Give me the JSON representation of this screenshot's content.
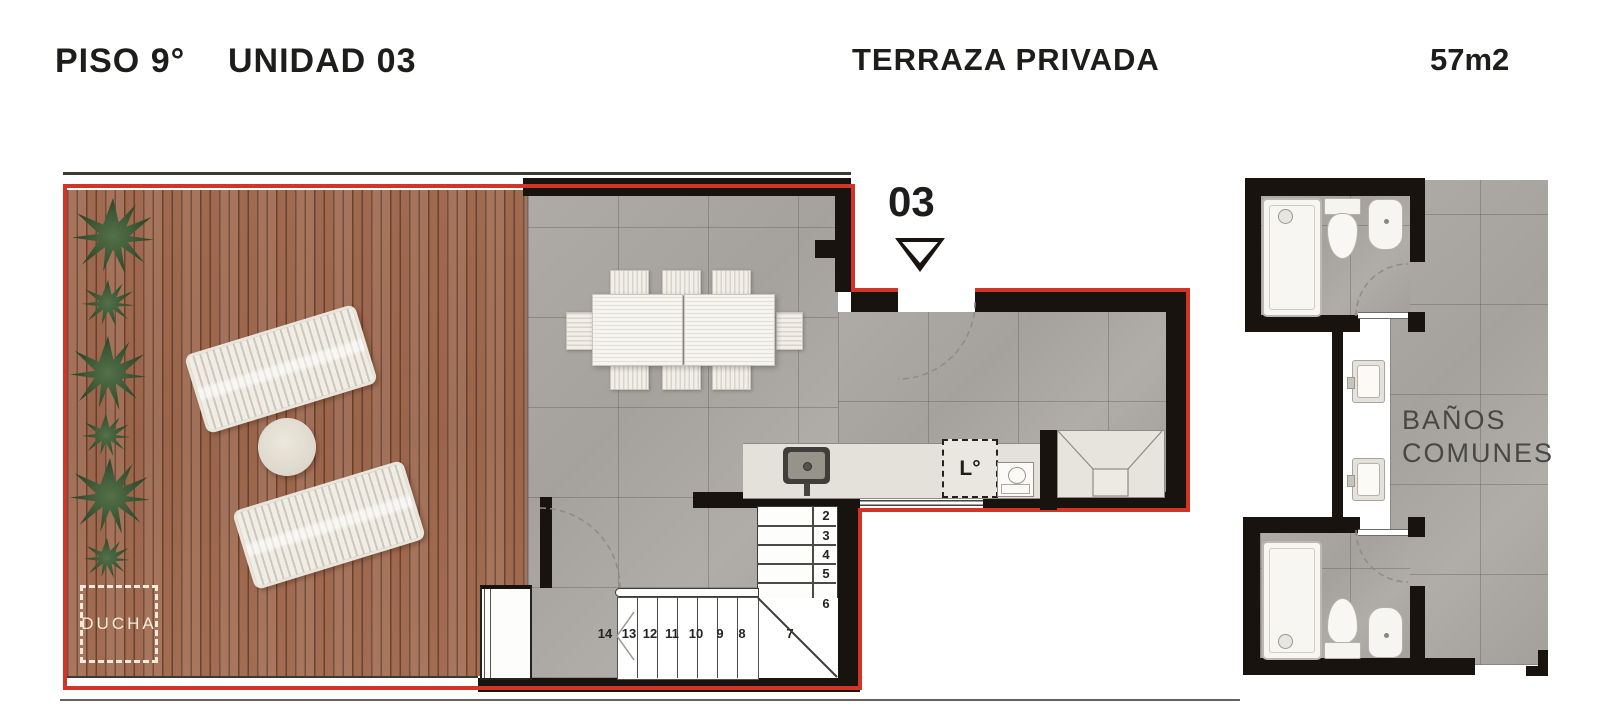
{
  "header": {
    "floor_label": "PISO 9°",
    "unit_label": "UNIDAD  03",
    "zone_label": "TERRAZA PRIVADA",
    "area_label": "57m2"
  },
  "plan": {
    "unit_marker": "03",
    "terrace": {
      "ducha_label": "DUCHA"
    },
    "kitchen": {
      "laundry_label": "L°"
    },
    "stairs": {
      "vertical": [
        "2",
        "3",
        "4",
        "5",
        "6"
      ],
      "winder": "7",
      "horizontal": [
        "14",
        "13",
        "12",
        "11",
        "10",
        "9",
        "8"
      ]
    }
  },
  "right_section": {
    "label_line1": "BAÑOS",
    "label_line2": "COMUNES"
  },
  "colors": {
    "outline_red": "#d23527",
    "wall_black": "#191310",
    "tile_gray": "#a8a5a0",
    "deck_wood": "#9d6950"
  }
}
